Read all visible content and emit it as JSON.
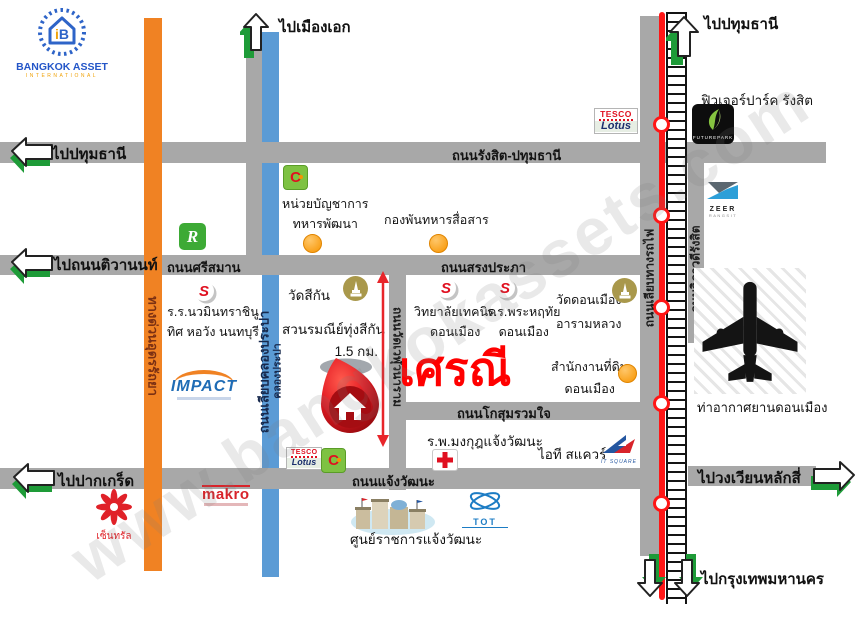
{
  "watermark": "www.bangkokassets.com",
  "logo": {
    "symbol_i": "i",
    "symbol_b": "B",
    "name": "BANGKOK ASSET",
    "subtitle": "INTERNATIONAL"
  },
  "project": {
    "name": "เศรณี",
    "distance": "1.5 กม."
  },
  "arrows": {
    "muang_ake": "ไปเมืองเอก",
    "pathum_top": "ไปปทุมธานี",
    "pathum_left": "ไปปทุมธานี",
    "tiwanon": "ไปถนนติวานนท์",
    "pak_kret": "ไปปากเกร็ด",
    "lak_si": "ไปวงเวียนหลักสี่",
    "bangkok": "ไปกรุงเทพมหานคร"
  },
  "roads": {
    "rangsit_pathum": "ถนนรังสิต-ปทุมธานี",
    "srisaman": "ถนนศรีสมาน",
    "songprapha": "ถนนสรงประภา",
    "kosum_ruamjai": "ถนนโกสุมรวมใจ",
    "chaengwattana": "ถนนแจ้งวัฒนะ",
    "udon_ratthaya": "ทางด่วนอุดรรัถยา",
    "liab_khlong_prapa": "ถนนเลียบคลองประปา",
    "khlong_prapa": "คลองประปา",
    "wat_weluwanaram": "ถนนวัดเวฬุวนาราม",
    "liab_thang_rotfai": "ถนนเลียบทางรถไฟ",
    "vibhavadi": "ถนนวิภาวดีรังสิต"
  },
  "landmarks": {
    "defense_hq": {
      "line1": "หน่วยบัญชาการ",
      "line2": "ทหารพัฒนา"
    },
    "signal_battalion": "กองพันทหารสื่อสาร",
    "future_park": "ฟิวเจอร์ปาร์ค รังสิต",
    "nawamin_school": {
      "line1": "ร.ร.นวมินทราชินู",
      "line2": "ทิศ หอวัง นนทบุรี"
    },
    "wat_sikan": "วัดสีกัน",
    "suan_romnee": "สวนรมณีย์ทุ่งสีกัน",
    "technical_college": {
      "line1": "วิทยาลัยเทคนิค",
      "line2": "ดอนเมือง"
    },
    "phra_haruthai": {
      "line1": "ร.ร.พระหฤทัย",
      "line2": "ดอนเมือง"
    },
    "wat_donmuang": {
      "line1": "วัดดอนเมือง",
      "line2": "อารามหลวง"
    },
    "land_office": {
      "line1": "สำนักงานที่ดิน",
      "line2": "ดอนเมือง"
    },
    "airport": "ท่าอากาศยานดอนเมือง",
    "hospital": "ร.พ.มงกุฎแจ้งวัฒนะ",
    "it_square": "ไอที สแควร์",
    "govt_center": "ศูนย์ราชการแจ้งวัฒนะ"
  },
  "logos": {
    "tesco": "TESCO",
    "lotus": "Lotus",
    "bigc": "C",
    "impact": "IMPACT",
    "makro": "makro",
    "central": "เซ็นทรัล",
    "robinson": "R",
    "s": "S",
    "zeer": "ZEER",
    "zeer_sub": "RANGSIT",
    "futurepark": "FUTUREPARK",
    "tot": "TOT",
    "itsq": "IT SQUARE"
  },
  "colors": {
    "road": "#a8a8a8",
    "expressway": "#f08223",
    "canal": "#5b9bd5",
    "railway": "#ff1616",
    "accent": "#ff0000",
    "arrow_green": "#1e9b38"
  }
}
